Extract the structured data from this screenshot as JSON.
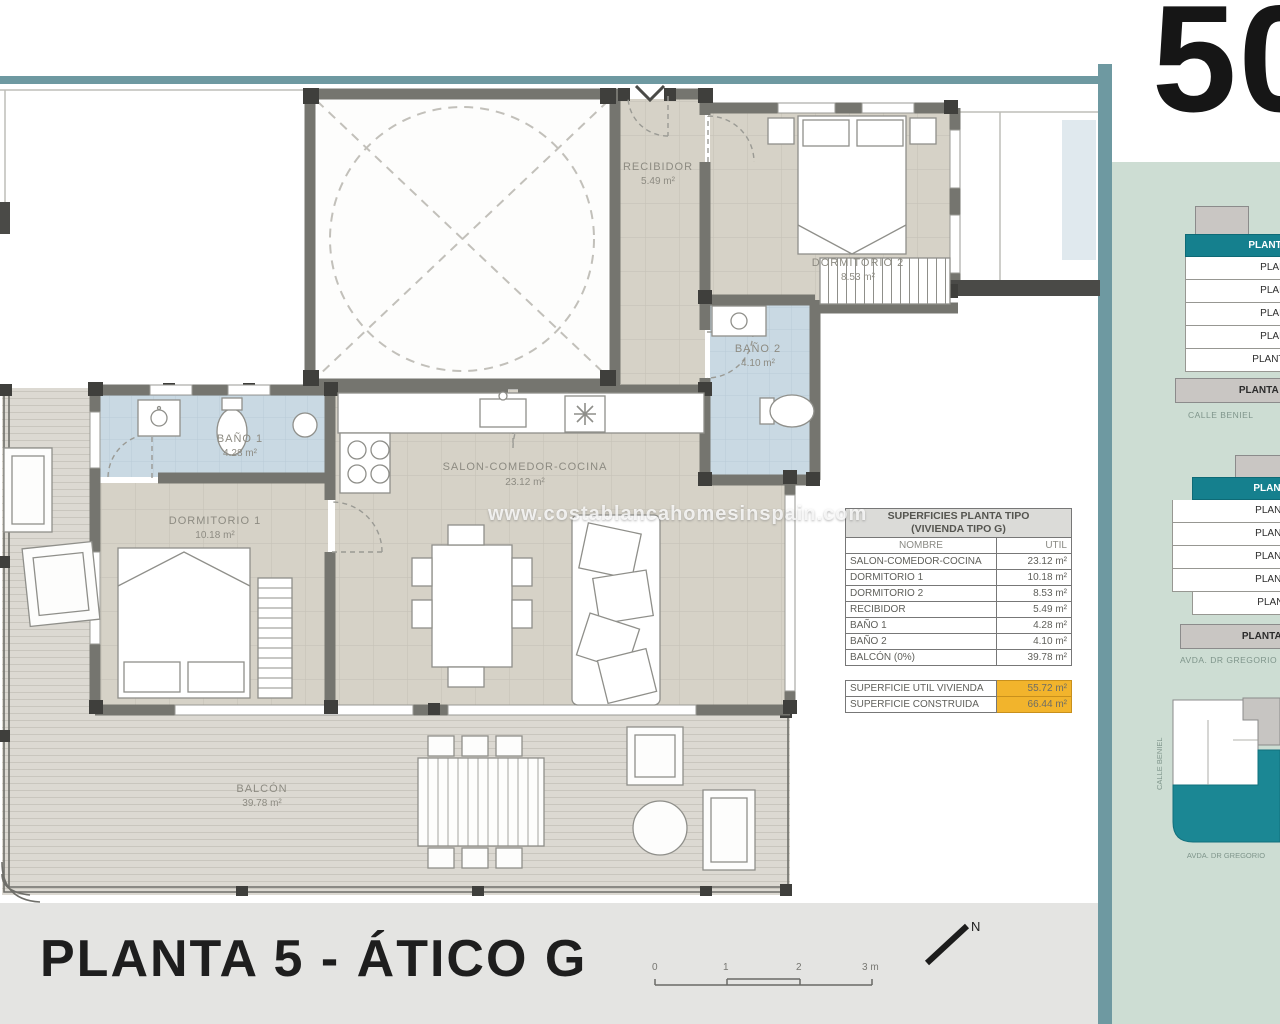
{
  "window": {
    "plan_number": "50",
    "watermark": "www.costablancahomesinspain.com"
  },
  "title_block": {
    "title": "PLANTA 5 - ÁTICO G",
    "scale_ticks": [
      "0",
      "1",
      "2",
      "3 m"
    ],
    "north_label": "N"
  },
  "rooms": {
    "recibidor": {
      "name": "RECIBIDOR",
      "area": "5.49 m²"
    },
    "dormitorio2": {
      "name": "DORMITORIO 2",
      "area": "8.53 m²"
    },
    "bano2": {
      "name": "BAÑO 2",
      "area": "4.10 m²"
    },
    "bano1": {
      "name": "BAÑO 1",
      "area": "4.28 m²"
    },
    "dormitorio1": {
      "name": "DORMITORIO 1",
      "area": "10.18 m²"
    },
    "salon": {
      "name": "SALON-COMEDOR-COCINA",
      "area": "23.12 m²"
    },
    "balcon": {
      "name": "BALCÓN",
      "area": "39.78 m²"
    }
  },
  "surfaces_table": {
    "title": "SUPERFICIES PLANTA TIPO",
    "subtitle": "(VIVIENDA TIPO G)",
    "columns": {
      "name": "NOMBRE",
      "util": "UTIL"
    },
    "rows": [
      {
        "name": "SALON-COMEDOR-COCINA",
        "util": "23.12 m²"
      },
      {
        "name": "DORMITORIO 1",
        "util": "10.18 m²"
      },
      {
        "name": "DORMITORIO 2",
        "util": "8.53 m²"
      },
      {
        "name": "RECIBIDOR",
        "util": "5.49 m²"
      },
      {
        "name": "BAÑO 1",
        "util": "4.28 m²"
      },
      {
        "name": "BAÑO 2",
        "util": "4.10 m²"
      },
      {
        "name": "BALCÓN (0%)",
        "util": "39.78 m²"
      }
    ]
  },
  "summary_table": {
    "rows": [
      {
        "label": "SUPERFICIE UTIL VIVIENDA",
        "value": "55.72 m²"
      },
      {
        "label": "SUPERFICIE CONSTRUIDA",
        "value": "66.44 m²"
      }
    ]
  },
  "side_panel": {
    "section_a": {
      "atico": "PLANTA ÁTICO",
      "floors": [
        "PLANTA 4ª",
        "PLANTA 3ª",
        "PLANTA 2ª",
        "PLANTA 1ª",
        "PLANTA BAJA"
      ],
      "sotano": "PLANTA SÓTANO",
      "street": "CALLE BENIEL"
    },
    "section_b": {
      "atico": "PLANTA ÁTICO",
      "floors": [
        "PLANTA 4ª",
        "PLANTA 3ª",
        "PLANTA 2ª",
        "PLANTA 1ª",
        "PLANTA BAJA"
      ],
      "sotano": "PLANTA SÓTANO",
      "street": "AVDA. DR GREGORIO"
    },
    "site": {
      "street_side": "CALLE BENIEL",
      "street_bottom": "AVDA. DR GREGORIO"
    }
  },
  "colors": {
    "frame_teal": "#6e99a1",
    "accent_teal": "#15808e",
    "panel_green": "#cdddd3",
    "highlight_orange": "#f2b42c",
    "tile_beige": "#d6d2c7",
    "tile_blue": "#c9d9e3",
    "wall_gray": "#75756f",
    "band_gray": "#e4e4e2"
  }
}
